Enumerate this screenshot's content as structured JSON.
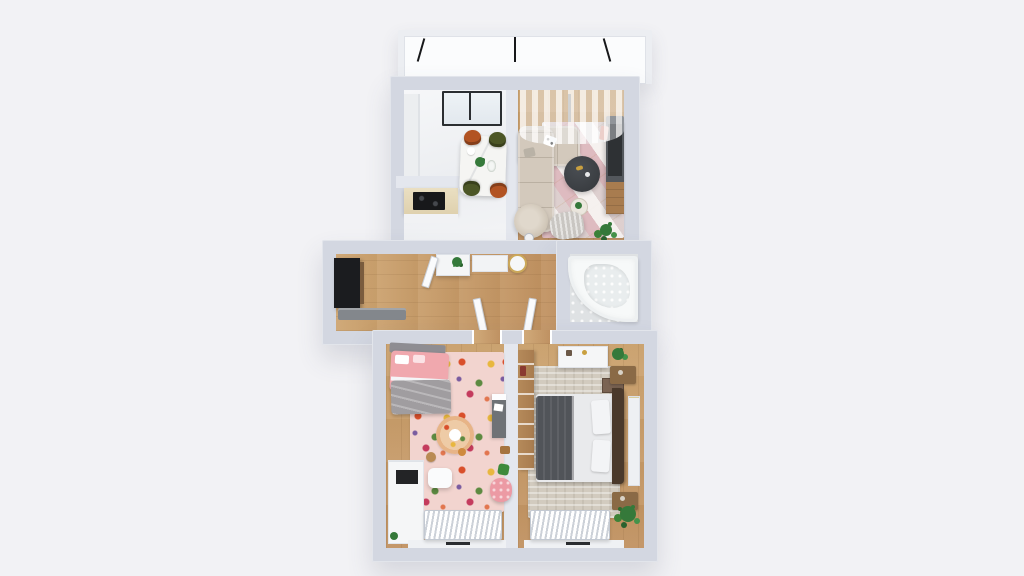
{
  "scene": {
    "kind": "3d-floor-plan-render",
    "view": "top-down",
    "background": "#f2f2f5",
    "description": "Rendered top-down 3D floor plan of a two-bedroom apartment with balcony"
  },
  "palette": {
    "bg": "#f2f2f5",
    "wall": "#d3d7e1",
    "wall-inner": "#e4e7ee",
    "white": "#fafbfc",
    "wood": "#cda470",
    "wood-dark": "#c09160",
    "tile": "#dfe2e4",
    "sofa": "#d3c9bc",
    "rug-living-base": "#eadcda",
    "rug-child-base": "#f2d4cf",
    "rug-master-base": "#d2cbbf",
    "bed-pink": "#f0a8ae",
    "blanket-gray": "#a09da0",
    "bed-dark": "#515459",
    "duvet-white": "#e9eaec",
    "headboard-brown": "#4a392b",
    "chair-terracotta": "#b25322",
    "chair-olive": "#4c5626",
    "table-marble": "#f5f5f3",
    "coffee-table": "#3f4246",
    "console-dark": "#53575c",
    "wood-furniture": "#a87c4f",
    "cooktop": "#17181a",
    "wardrobe-dark": "#1b1c1f",
    "bench-gray": "#83878c",
    "plant-green": "#35793a",
    "plant-green-dark": "#2a622e",
    "radiator-slat": "#ccd1d8",
    "tub-white": "#f7f9f9",
    "gold": "#c9a040",
    "pink-accent": "#ec9aa4",
    "frame-dark": "#2b2e31",
    "desk-gray": "#6e7276",
    "armchair-gray": "#c9c6c2"
  },
  "rooms": [
    {
      "id": "balcony",
      "name": "Balcony",
      "furniture": [
        "glass railing",
        "railing posts"
      ]
    },
    {
      "id": "kitchen",
      "name": "Kitchen / Dining",
      "furniture": [
        "balcony glass door",
        "tall cabinet",
        "marble dining table",
        "two terracotta chairs",
        "two olive chairs",
        "counter with cooktop"
      ]
    },
    {
      "id": "living-room",
      "name": "Living Room",
      "furniture": [
        "corner sofa",
        "throw pillows",
        "coffee table",
        "side table",
        "accent chair",
        "tv console",
        "geometric rug",
        "sheer curtains",
        "floor plant",
        "armchair",
        "floor lamp"
      ]
    },
    {
      "id": "hallway",
      "name": "Hallway / Entry",
      "furniture": [
        "dark wardrobe",
        "gray bench",
        "console cabinet",
        "plant",
        "round stand",
        "door leaves"
      ]
    },
    {
      "id": "bathroom",
      "name": "Bathroom",
      "furniture": [
        "corner bathtub"
      ]
    },
    {
      "id": "kids-bedroom",
      "name": "Kids Bedroom",
      "furniture": [
        "single bed pink",
        "gray blanket",
        "floral rug",
        "round play mat",
        "stools",
        "desk",
        "white dresser",
        "pink pouf",
        "white table",
        "radiator",
        "window"
      ]
    },
    {
      "id": "master-bedroom",
      "name": "Master Bedroom",
      "furniture": [
        "double bed",
        "dark duvet",
        "brown headboard",
        "two nightstands",
        "wardrobe",
        "white dresser",
        "textured rug",
        "wall shelf",
        "floor plant",
        "radiator",
        "window"
      ]
    }
  ]
}
